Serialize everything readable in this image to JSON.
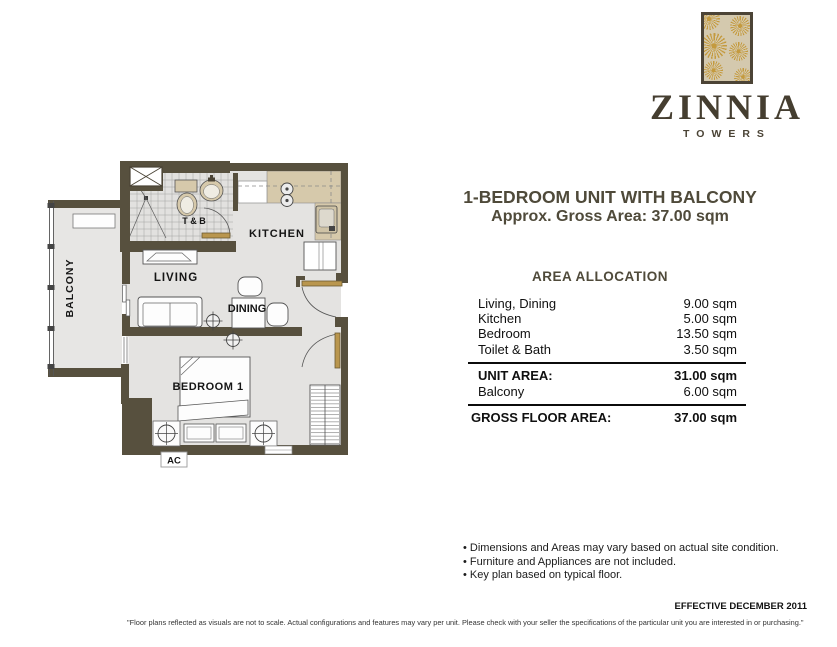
{
  "logo": {
    "name": "ZINNIA",
    "subtitle": "TOWERS"
  },
  "title": {
    "line1": "1-BEDROOM UNIT WITH BALCONY",
    "line2": "Approx. Gross Area: 37.00 sqm"
  },
  "allocation": {
    "heading": "AREA ALLOCATION",
    "rows": [
      {
        "label": "Living, Dining",
        "value": "9.00 sqm"
      },
      {
        "label": "Kitchen",
        "value": "5.00 sqm"
      },
      {
        "label": "Bedroom",
        "value": "13.50 sqm"
      },
      {
        "label": "Toilet & Bath",
        "value": "3.50 sqm"
      }
    ],
    "unit_area": {
      "label": "UNIT AREA:",
      "value": "31.00 sqm"
    },
    "balcony_row": {
      "label": "Balcony",
      "value": "6.00 sqm"
    },
    "gross": {
      "label": "GROSS FLOOR AREA:",
      "value": "37.00 sqm"
    }
  },
  "floorplan": {
    "labels": {
      "balcony": "BALCONY",
      "tb": "T & B",
      "kitchen": "KITCHEN",
      "living": "LIVING",
      "dining": "DINING",
      "bedroom": "BEDROOM 1",
      "ac": "AC"
    }
  },
  "notes": {
    "items": [
      "Dimensions and Areas may vary based on actual site condition.",
      "Furniture and Appliances are not included.",
      "Key plan based on typical floor."
    ],
    "effective": "EFFECTIVE DECEMBER 2011"
  },
  "footer": {
    "disclaimer": "\"Floor plans reflected as visuals are not to scale. Actual configurations and features may vary per unit. Please check with your seller the specifications of the particular unit you are interested in or purchasing.\""
  },
  "colors": {
    "wall": "#57503e",
    "floor": "#e4e3e1",
    "counter": "#d6c9ab",
    "door": "#b9964e",
    "accent_text": "#4f4a3a",
    "logo_gold": "#c49a3e",
    "logo_background": "#d4c9ae",
    "table_text": "#101010"
  }
}
